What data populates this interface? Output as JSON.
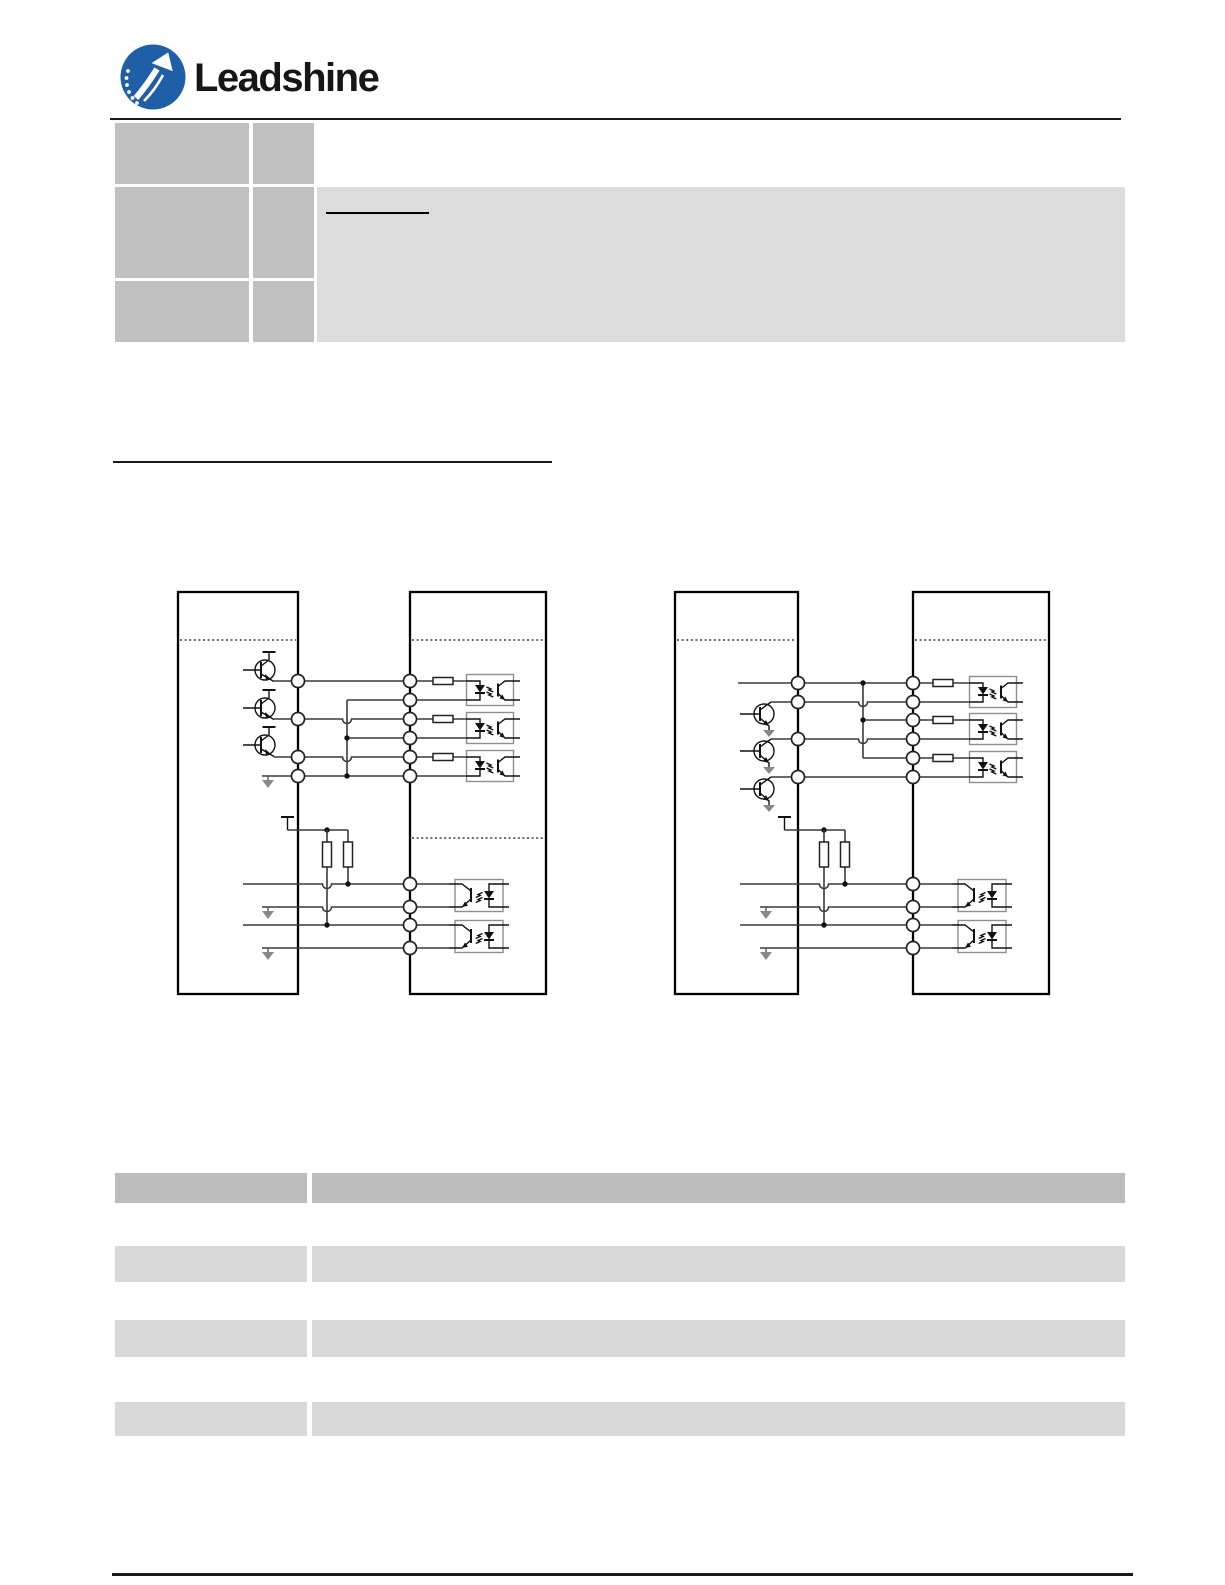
{
  "brand": {
    "name": "Leadshine",
    "logo_blue": "#1f5fa8",
    "wordmark_color": "#161616"
  },
  "colors": {
    "rule": "#1a1a1a",
    "top_table_header_cells": "#c0c0c0",
    "top_table_body": "#dcdcdc",
    "bottom_table_header": "#bdbdbd",
    "bottom_table_rows": "#d9d9d9",
    "wire": "#3a3a3a"
  },
  "top_table": {
    "note": "text layer not rendered in source image; cells appear empty",
    "rows": [
      {
        "col1": "",
        "col2": "",
        "content": ""
      },
      {
        "col1": "",
        "col2": "",
        "content": ""
      },
      {
        "col1": "",
        "col2": "",
        "content": ""
      }
    ],
    "underline_snippet": ""
  },
  "section_heading": {
    "text": "",
    "underlined": true
  },
  "diagrams": {
    "left": {
      "name": "connection-diagram-left",
      "control_signal_channels": 3,
      "driver_input_terminals": 6,
      "driver_output_channels": 2,
      "pullup_resistors": 2
    },
    "right": {
      "name": "connection-diagram-right",
      "control_signal_channels": 3,
      "driver_input_terminals": 6,
      "driver_output_channels": 2,
      "pullup_resistors": 2
    }
  },
  "bottom_table": {
    "note": "text layer not rendered in source image; cells appear empty",
    "header": {
      "col1": "",
      "col2": ""
    },
    "rows": [
      {
        "col1": "",
        "col2": ""
      },
      {
        "col1": "",
        "col2": ""
      },
      {
        "col1": "",
        "col2": ""
      }
    ]
  }
}
